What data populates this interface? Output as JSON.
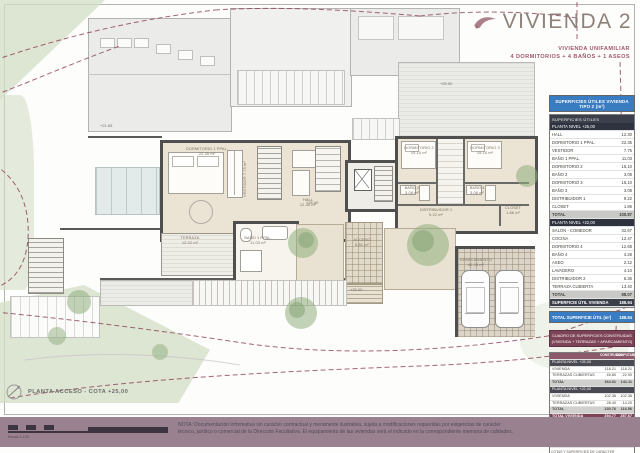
{
  "title": {
    "text": "VIVIENDA 2",
    "subtitle_line1": "VIVIENDA UNIFAMILIAR",
    "subtitle_line2": "4 DORMITORIOS + 4 BAÑOS + 1 ASEOS"
  },
  "plan": {
    "rooms": {
      "dorm1": {
        "name": "DORMITORIO 1 PPAL.",
        "area": "22.35 m²"
      },
      "vestidor": {
        "name": "VESTIDOR",
        "area": "7.75 m²"
      },
      "hall": {
        "name": "HALL",
        "area": "12.30 m²"
      },
      "dorm2": {
        "name": "DORMITORIO 2",
        "area": "15.10 m²"
      },
      "dorm3": {
        "name": "DORMITORIO 3",
        "area": "15.10 m²"
      },
      "bano2": {
        "name": "BAÑO 2",
        "area": "3.08 m²"
      },
      "bano3": {
        "name": "BAÑO 3",
        "area": "3.08 m²"
      },
      "distribuidor": {
        "name": "DISTRIBUIDOR 1",
        "area": "9.22 m²"
      },
      "closet": {
        "name": "CLOSET",
        "area": "1.86 m²"
      },
      "terraza": {
        "name": "TERRAZA",
        "area": "12.02 m²"
      },
      "bano1": {
        "name": "BAÑO 1 PPAL.",
        "area": "11.03 m²"
      },
      "acceso": {
        "name": "ACCESO",
        "area": "5.81 m²"
      },
      "aparcamiento": {
        "name": "APARCAMIENTO",
        "area": "40.28 m²"
      }
    },
    "levels": [
      {
        "label": "+21.65"
      },
      {
        "label": "+25.00"
      },
      {
        "label": "+25.00"
      },
      {
        "label": "+25.00"
      }
    ]
  },
  "tables": {
    "main_header": "SUPERFICIES ÚTILES VIVIENDA TIPO 2 (m²)",
    "utiles_header": "SUPERFICIES ÚTILES",
    "utiles_rows": [
      {
        "t": "sub",
        "l": "PLANTA NIVEL +25,00",
        "v": ""
      },
      {
        "t": "row",
        "l": "HALL",
        "v": "12.30"
      },
      {
        "t": "row",
        "l": "DORMITORIO 1 PPAL.",
        "v": "22.35"
      },
      {
        "t": "row",
        "l": "VESTIDOR",
        "v": "7.75"
      },
      {
        "t": "row",
        "l": "BAÑO 1 PPAL.",
        "v": "11.03"
      },
      {
        "t": "row",
        "l": "DORMITORIO 2",
        "v": "15.10"
      },
      {
        "t": "row",
        "l": "BAÑO 2",
        "v": "3.08"
      },
      {
        "t": "row",
        "l": "DORMITORIO 3",
        "v": "15.10"
      },
      {
        "t": "row",
        "l": "BAÑO 3",
        "v": "3.08"
      },
      {
        "t": "row",
        "l": "DISTRIBUIDOR 1",
        "v": "9.22"
      },
      {
        "t": "row",
        "l": "CLOSET",
        "v": "1.86"
      },
      {
        "t": "total",
        "l": "TOTAL",
        "v": "100.87"
      },
      {
        "t": "sub",
        "l": "PLANTA NIVEL +22,00",
        "v": ""
      },
      {
        "t": "row",
        "l": "SALÓN - COMEDOR",
        "v": "32.67"
      },
      {
        "t": "row",
        "l": "COCINA",
        "v": "12.47"
      },
      {
        "t": "row",
        "l": "DORMITORIO 4",
        "v": "12.68"
      },
      {
        "t": "row",
        "l": "BAÑO 4",
        "v": "4.28"
      },
      {
        "t": "row",
        "l": "ASEO",
        "v": "2.12"
      },
      {
        "t": "row",
        "l": "LAVADERO",
        "v": "4.10"
      },
      {
        "t": "row",
        "l": "DISTRIBUIDOR 2",
        "v": "6.35"
      },
      {
        "t": "row",
        "l": "TERRAZA CUBIERTA",
        "v": "13.40"
      },
      {
        "t": "total",
        "l": "TOTAL",
        "v": "88.07"
      },
      {
        "t": "dark",
        "l": "SUPERFICIE ÚTIL VIVIENDA",
        "v": "188.94"
      }
    ],
    "blue_total": {
      "l": "TOTAL SUPERFICIE ÚTIL (m²)",
      "v": "188.94"
    },
    "construidas_header_line1": "CUADRO DE SUPERFICIES CONSTRUIDAS",
    "construidas_header_line2": "(VIVIENDA + TERRAZAS + APARCAMIENTO)",
    "construidas_rows": [
      {
        "t": "head",
        "l": "",
        "a": "CONSTRUIDA",
        "b": "COMPUTABLE"
      },
      {
        "t": "sub",
        "l": "PLANTA NIVEL +25,00",
        "a": "",
        "b": ""
      },
      {
        "t": "row",
        "l": "VIVIENDA",
        "a": "118.21",
        "b": "118.21"
      },
      {
        "t": "row",
        "l": "TERRAZAS CUBIERTAS",
        "a": "45.80",
        "b": "22.90"
      },
      {
        "t": "total",
        "l": "TOTAL",
        "a": "164.01",
        "b": "141.11"
      },
      {
        "t": "sub",
        "l": "PLANTA NIVEL +22,00",
        "a": "",
        "b": ""
      },
      {
        "t": "row",
        "l": "VIVIENDA",
        "a": "102.36",
        "b": "102.36"
      },
      {
        "t": "row",
        "l": "TERRAZAS CUBIERTAS",
        "a": "28.40",
        "b": "14.20"
      },
      {
        "t": "total",
        "l": "TOTAL",
        "a": "130.76",
        "b": "116.56"
      },
      {
        "t": "maroon",
        "l": "TOTAL VIVIENDA",
        "a": "294.77",
        "b": "257.67"
      },
      {
        "t": "sub",
        "l": "APARCAMIENTO",
        "a": "",
        "b": ""
      },
      {
        "t": "row",
        "l": "APARCAMIENTO",
        "a": "40.28",
        "b": "20.14"
      },
      {
        "t": "total",
        "l": "TOTAL",
        "a": "40.28",
        "b": "20.14"
      },
      {
        "t": "maroon",
        "l": "TOTAL CONSTRUIDA",
        "a": "335.05",
        "b": "277.81"
      }
    ],
    "footnote_line1": "COTAS Y SUPERFICIES DE CARÁCTER ORIENTATIVO.",
    "footnote_line2": "SUSCEPTIBLES DE MODIFICACIÓN EN PROYECTO DE EJECUCIÓN."
  },
  "footer": {
    "plan_label": "PLANTA ACCESO - COTA +25,00",
    "scale_label": "Escala 1:100",
    "note_line1": "NOTA: Documentación informativa sin carácter contractual y meramente ilustrativa, sujeta a modificaciones requeridas por exigencias de carácter",
    "note_line2": "técnico, jurídico o comercial de la Dirección Facultativa. El equipamiento de las viviendas será el indicado en la correspondiente memoria de calidades."
  },
  "colors": {
    "table_header_blue": "#3a7cc1",
    "table_header_maroon": "#7d4458",
    "footer_strip_mauve": "#9a8190",
    "contour_line_maroon": "#8c3f56",
    "room_floor_beige": "#ebe3d3",
    "wall_gray": "#4f4f4f"
  }
}
